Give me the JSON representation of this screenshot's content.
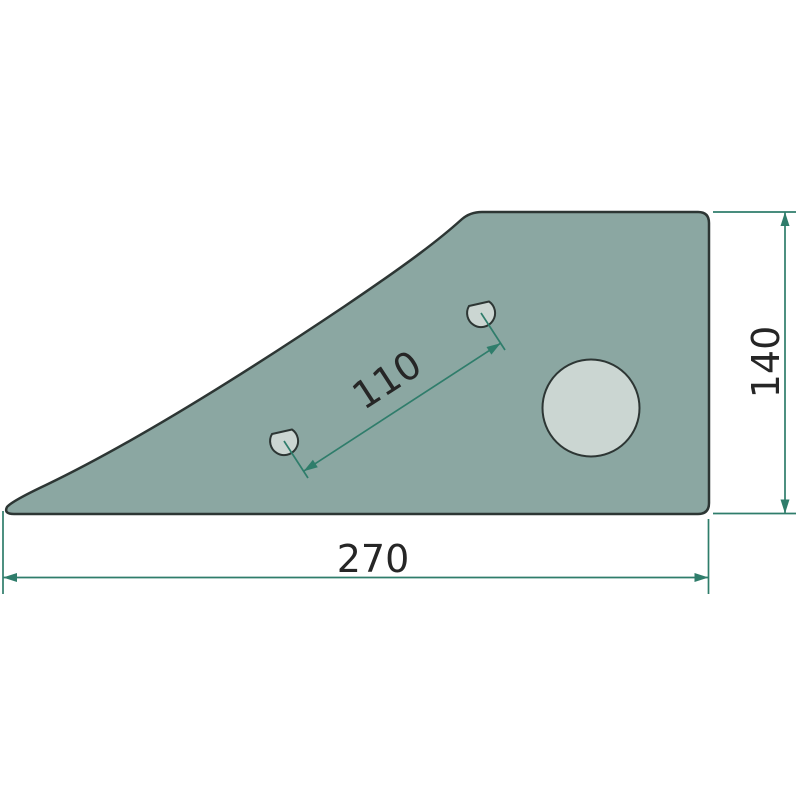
{
  "drawing": {
    "title": "flat wedge-shaped plate with three holes (technical drawing)",
    "dimensions": {
      "overall_width": {
        "value": "270"
      },
      "overall_height": {
        "value": "140"
      },
      "hole_spacing": {
        "value": "110"
      }
    },
    "features": {
      "large_hole_count": 1,
      "small_hole_count": 2
    },
    "colors": {
      "background": "#ffffff",
      "part_fill": "#8ba7a2",
      "part_outline": "#2d3634",
      "hole_fill": "#cbd6d2",
      "hole_outline": "#2d3634",
      "dimension_line": "#2f7d6b",
      "label_text": "#262626"
    }
  }
}
